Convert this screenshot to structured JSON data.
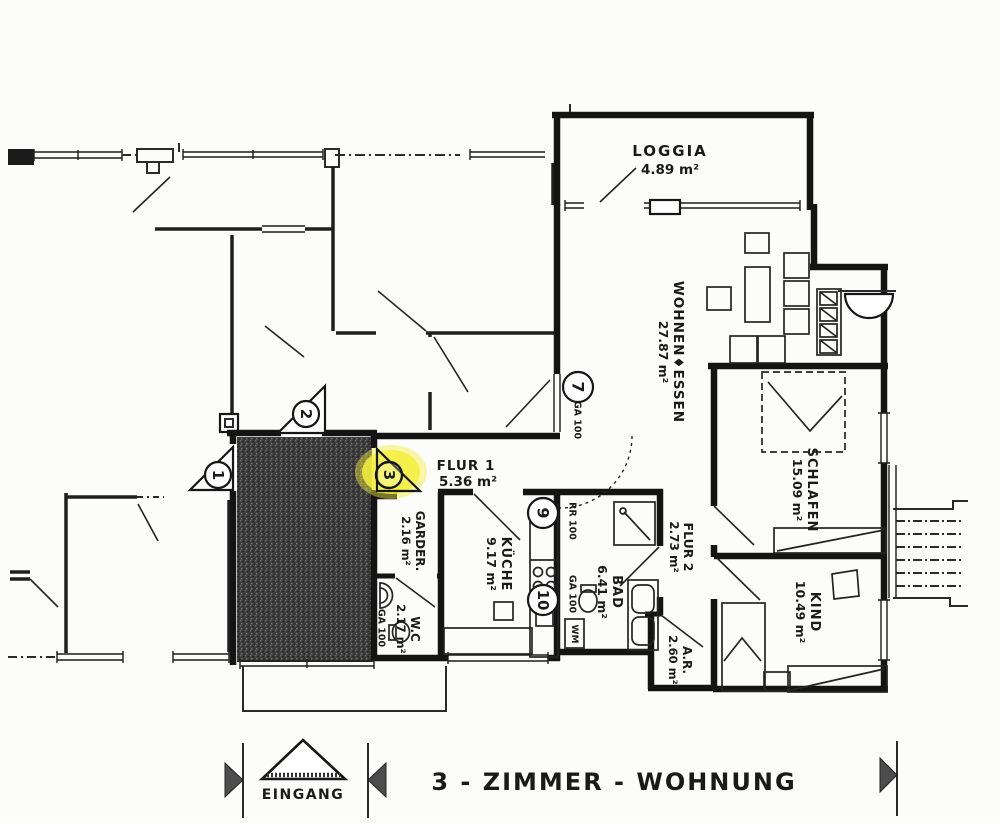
{
  "title": "3 - ZIMMER - WOHNUNG",
  "entrance": {
    "label": "EINGANG"
  },
  "rooms": {
    "loggia": {
      "name": "LOGGIA",
      "area": "4.89 m²"
    },
    "wohnen": {
      "name": "WOHNEN♦ESSEN",
      "area": "27.87 m²"
    },
    "schlafen": {
      "name": "SCHLAFEN",
      "area": "15.09 m²"
    },
    "kind": {
      "name": "KIND",
      "area": "10.49 m²"
    },
    "flur1": {
      "name": "FLUR 1",
      "area": "5.36 m²"
    },
    "flur2": {
      "name": "FLUR 2",
      "area": "2.73 m²"
    },
    "garderobe": {
      "name": "GARDER.",
      "area": "2.16 m²"
    },
    "kueche": {
      "name": "KÜCHE",
      "area": "9.17 m²"
    },
    "bad": {
      "name": "BAD",
      "area": "6.41 m²"
    },
    "wc": {
      "name": "W.C",
      "area": "2.17 m²"
    },
    "abstellraum": {
      "name": "A.R.",
      "area": "2.60 m²"
    }
  },
  "door_numbers": {
    "d1": "1",
    "d2": "2",
    "d3": "3",
    "d7": "7",
    "d9": "9",
    "d10": "10"
  },
  "annotations": {
    "rr100": "RR 100",
    "ga100": "GA 100",
    "wm": "WM"
  },
  "highlight": {
    "color": "#f4ef3c",
    "highlighted_door": "3"
  }
}
